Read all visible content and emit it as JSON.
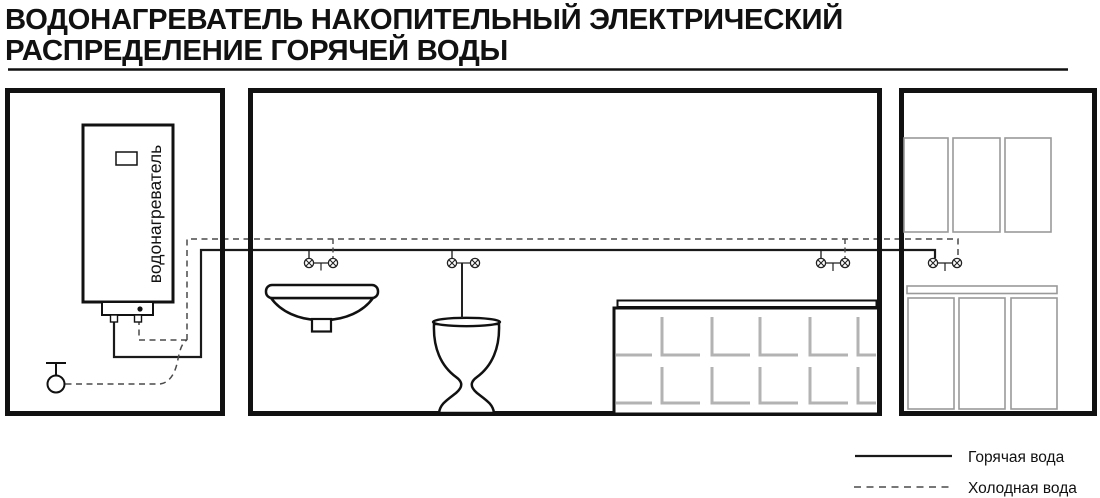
{
  "title": {
    "line1": "ВОДОНАГРЕВАТЕЛЬ НАКОПИТЕЛЬНЫЙ ЭЛЕКТРИЧЕСКИЙ",
    "line2": "РАСПРЕДЕЛЕНИЕ ГОРЯЧЕЙ ВОДЫ"
  },
  "rooms": {
    "boiler": {
      "heater_label": "водонагреватель"
    }
  },
  "legend": {
    "hot_label": "Горячая вода",
    "cold_label": "Холодная вода"
  },
  "colors": {
    "ink": "#111111",
    "line_hot": "#1a1a1a",
    "line_cold": "#4a4a4a",
    "tile_gray": "#b3b3b3",
    "cabinet_gray": "#999999"
  }
}
